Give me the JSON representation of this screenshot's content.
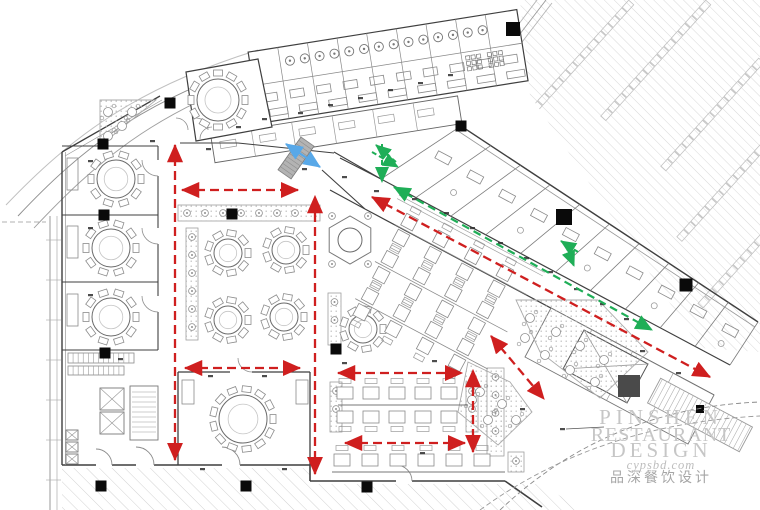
{
  "watermark": {
    "l1": "PINSHEN",
    "l2": "RESTAURANT",
    "l3": "DESIGN",
    "url": "cypsbd.com",
    "cn": "品深餐饮设计"
  },
  "floorplan": {
    "canvas": [
      760,
      510
    ],
    "colors": {
      "route_red": "#cf1f1f",
      "route_green": "#1fae57",
      "route_blue": "#58a8e8",
      "wall": "#3f3f3f",
      "furniture": "#7a7a7a",
      "hatch": "#d8d8d8",
      "column": "#0a0a0a",
      "shaft": "#4a4a4a",
      "watermark": "#c6c6c6"
    },
    "columns": [
      [
        170,
        103
      ],
      [
        103,
        144
      ],
      [
        104,
        215
      ],
      [
        232,
        214
      ],
      [
        105,
        353
      ],
      [
        336,
        349
      ],
      [
        101,
        486
      ],
      [
        246,
        486
      ],
      [
        367,
        487
      ],
      [
        461,
        126
      ],
      [
        513,
        29,
        14
      ],
      [
        564,
        217,
        16
      ],
      [
        686,
        285,
        13
      ],
      [
        700,
        409,
        8
      ]
    ],
    "dark_shaft": {
      "x": 629,
      "y": 386,
      "s": 22
    },
    "round_tables": [
      [
        218,
        100,
        21,
        12
      ],
      [
        116,
        179,
        19,
        10
      ],
      [
        111,
        248,
        19,
        10
      ],
      [
        111,
        317,
        19,
        10
      ],
      [
        243,
        419,
        24,
        13
      ],
      [
        228,
        253,
        14,
        9
      ],
      [
        286,
        250,
        14,
        9
      ],
      [
        228,
        320,
        14,
        9
      ],
      [
        284,
        317,
        14,
        9
      ],
      [
        363,
        329,
        14,
        9
      ]
    ],
    "hex_booth": [
      350,
      240,
      24
    ],
    "routes_red": [
      [
        [
          175,
          460
        ],
        [
          175,
          145
        ]
      ],
      [
        [
          182,
          190
        ],
        [
          298,
          190
        ]
      ],
      [
        [
          185,
          368
        ],
        [
          300,
          368
        ]
      ],
      [
        [
          315,
          474
        ],
        [
          315,
          196
        ]
      ],
      [
        [
          338,
          373
        ],
        [
          462,
          373
        ]
      ],
      [
        [
          345,
          443
        ],
        [
          465,
          443
        ]
      ],
      [
        [
          473,
          452
        ],
        [
          473,
          370
        ]
      ],
      [
        [
          372,
          197
        ],
        [
          710,
          377
        ]
      ],
      [
        [
          491,
          336
        ],
        [
          544,
          399
        ]
      ]
    ],
    "routes_green_main": [
      [
        [
          394,
          187
        ],
        [
          652,
          330
        ]
      ]
    ],
    "routes_green_small": [
      [
        [
          396,
          162
        ],
        [
          376,
          145
        ]
      ],
      [
        [
          382,
          144
        ],
        [
          382,
          182
        ]
      ],
      [
        [
          372,
          152
        ],
        [
          398,
          167
        ]
      ],
      [
        [
          578,
          252
        ],
        [
          561,
          241
        ]
      ],
      [
        [
          566,
          246
        ],
        [
          574,
          266
        ]
      ]
    ],
    "routes_blue": [
      [
        [
          286,
          144
        ],
        [
          320,
          167
        ]
      ]
    ],
    "sq_grid": {
      "ox": 405,
      "oy": 205,
      "angle": 28,
      "cols": 4,
      "rows": 3,
      "dx": 36,
      "dy": 42
    },
    "banquet": {
      "rows": [
        {
          "y": 393,
          "n": 5,
          "x0": 345,
          "dx": 26,
          "side": -1
        },
        {
          "y": 417,
          "n": 5,
          "x0": 345,
          "dx": 26,
          "side": 1
        },
        {
          "y": 460,
          "n": 6,
          "x0": 342,
          "dx": 28,
          "side": -1
        }
      ],
      "divider": [
        [
          338,
          405
        ],
        [
          468,
          405
        ]
      ],
      "counter": [
        [
          332,
          472
        ],
        [
          505,
          472
        ]
      ]
    },
    "parking": {
      "chains": [
        [
          628,
          6,
          16
        ],
        [
          705,
          6,
          15
        ],
        [
          758,
          64,
          14
        ],
        [
          760,
          150,
          12
        ],
        [
          760,
          240,
          9
        ]
      ],
      "dir": [
        -0.67,
        0.74
      ],
      "step": 10.5
    },
    "terraces": [
      {
        "poly": [
          [
            516,
            300
          ],
          [
            598,
            300
          ],
          [
            648,
            352
          ],
          [
            600,
            398
          ],
          [
            540,
            352
          ]
        ],
        "tables": [
          [
            530,
            318
          ],
          [
            556,
            332
          ],
          [
            580,
            346
          ],
          [
            604,
            360
          ],
          [
            545,
            355
          ],
          [
            570,
            370
          ],
          [
            595,
            382
          ],
          [
            525,
            338
          ]
        ]
      },
      {
        "poly": [
          [
            468,
            362
          ],
          [
            510,
            382
          ],
          [
            532,
            412
          ],
          [
            498,
            445
          ],
          [
            458,
            412
          ]
        ],
        "tables": [
          [
            480,
            392
          ],
          [
            502,
            404
          ],
          [
            516,
            420
          ],
          [
            488,
            420
          ],
          [
            472,
            400
          ]
        ]
      },
      {
        "poly": [
          [
            100,
            100
          ],
          [
            156,
            100
          ],
          [
            100,
            146
          ]
        ],
        "tables": [
          [
            108,
            112
          ],
          [
            122,
            126
          ],
          [
            108,
            136
          ],
          [
            132,
            112
          ]
        ]
      }
    ],
    "planters": [
      [
        178,
        205,
        142,
        16
      ],
      [
        186,
        228,
        12,
        112
      ],
      [
        328,
        293,
        13,
        52
      ],
      [
        330,
        382,
        12,
        50
      ],
      [
        466,
        382,
        12,
        50
      ],
      [
        487,
        368,
        17,
        88
      ],
      [
        508,
        452,
        16,
        20
      ]
    ],
    "micro_marks": [
      [
        150,
        140
      ],
      [
        206,
        148
      ],
      [
        236,
        126
      ],
      [
        172,
        157
      ],
      [
        262,
        118
      ],
      [
        298,
        112
      ],
      [
        328,
        104
      ],
      [
        358,
        97
      ],
      [
        388,
        89
      ],
      [
        418,
        82
      ],
      [
        448,
        74
      ],
      [
        302,
        168
      ],
      [
        342,
        176
      ],
      [
        374,
        190
      ],
      [
        412,
        198
      ],
      [
        444,
        212
      ],
      [
        470,
        227
      ],
      [
        498,
        242
      ],
      [
        524,
        257
      ],
      [
        548,
        271
      ],
      [
        574,
        288
      ],
      [
        600,
        303
      ],
      [
        624,
        318
      ],
      [
        88,
        160
      ],
      [
        88,
        227
      ],
      [
        88,
        294
      ],
      [
        118,
        358
      ],
      [
        208,
        375
      ],
      [
        262,
        375
      ],
      [
        342,
        362
      ],
      [
        432,
        360
      ],
      [
        200,
        468
      ],
      [
        282,
        468
      ],
      [
        420,
        452
      ],
      [
        520,
        408
      ],
      [
        560,
        428
      ],
      [
        640,
        350
      ],
      [
        676,
        372
      ]
    ]
  }
}
